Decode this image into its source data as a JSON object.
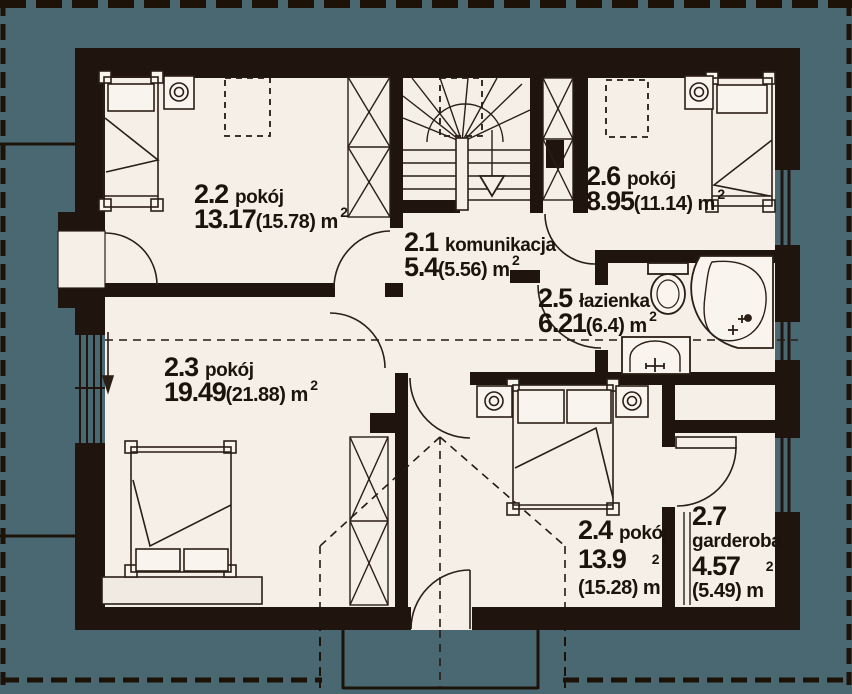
{
  "unit": {
    "label": "m",
    "sup": "2"
  },
  "colors": {
    "roof_background": "#4a6872",
    "floor": "#f6efe8",
    "wall": "#1f150e",
    "line": "#2a1f16"
  },
  "rooms": [
    {
      "number": "2.2",
      "name": "pokój",
      "area": "13.17",
      "gross": "(15.78)"
    },
    {
      "number": "2.1",
      "name": "komunikacja",
      "area": "5.4",
      "gross": "(5.56)"
    },
    {
      "number": "2.6",
      "name": "pokój",
      "area": "8.95",
      "gross": "(11.14)"
    },
    {
      "number": "2.5",
      "name": "łazienka",
      "area": "6.21",
      "gross": "(6.4)"
    },
    {
      "number": "2.3",
      "name": "pokój",
      "area": "19.49",
      "gross": "(21.88)"
    },
    {
      "number": "2.4",
      "name": "pokój",
      "area": "13.9",
      "gross": "(15.28)"
    },
    {
      "number": "2.7",
      "name": "garderoba",
      "area": "4.57",
      "gross": "(5.49)"
    }
  ]
}
